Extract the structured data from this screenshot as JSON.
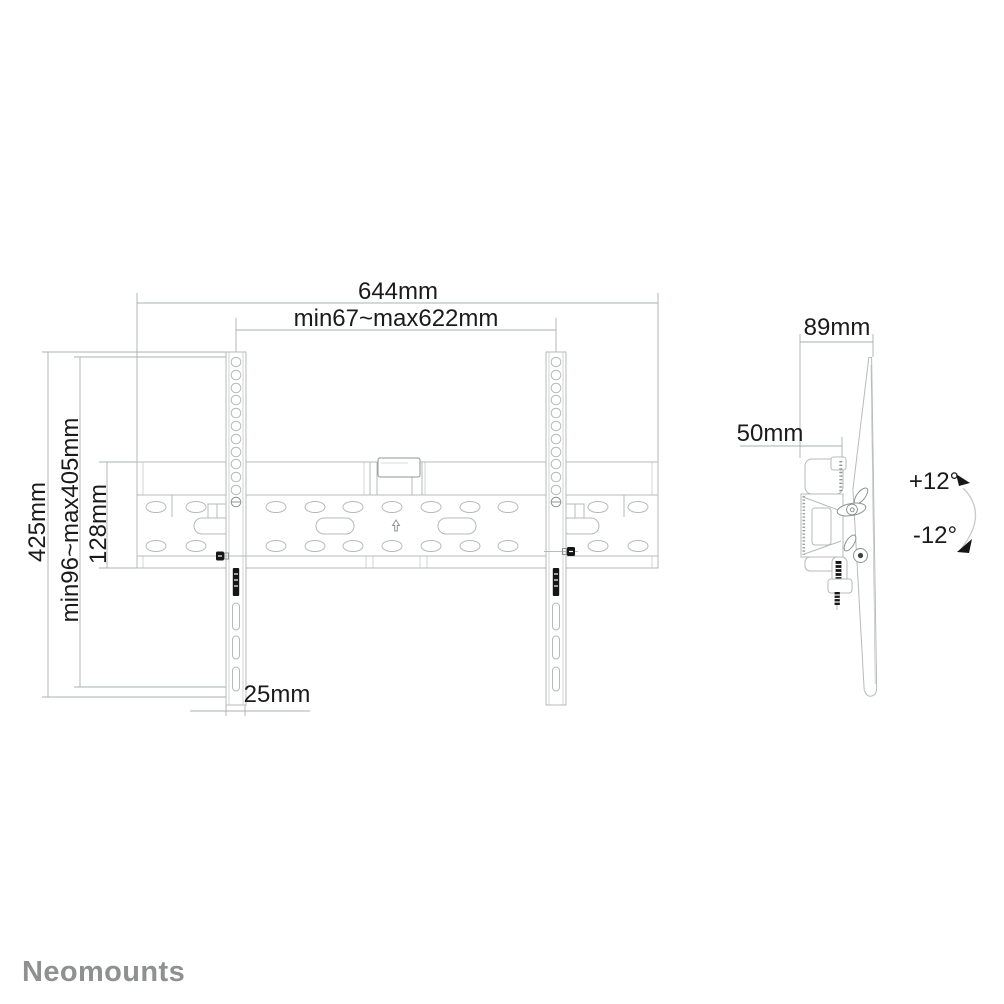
{
  "colors": {
    "background": "#ffffff",
    "line": "#b4bbb9",
    "line_strong": "#8d9593",
    "dim_line": "#a9b0ae",
    "text": "#1b1b1b",
    "black_detail": "#161616",
    "arc": "#c6ccca",
    "logo": "#8f9090"
  },
  "logo": {
    "text": "Neomounts"
  },
  "front_view": {
    "dim_total_width": "644mm",
    "dim_stud_range": "min67~max622mm",
    "dim_total_height": "425mm",
    "dim_height_range": "min96~max405mm",
    "dim_plate_height": "128mm",
    "dim_rail_width": "25mm"
  },
  "side_view": {
    "dim_depth": "89mm",
    "dim_wall_offset": "50mm",
    "tilt_up": "+12°",
    "tilt_down": "-12°"
  }
}
